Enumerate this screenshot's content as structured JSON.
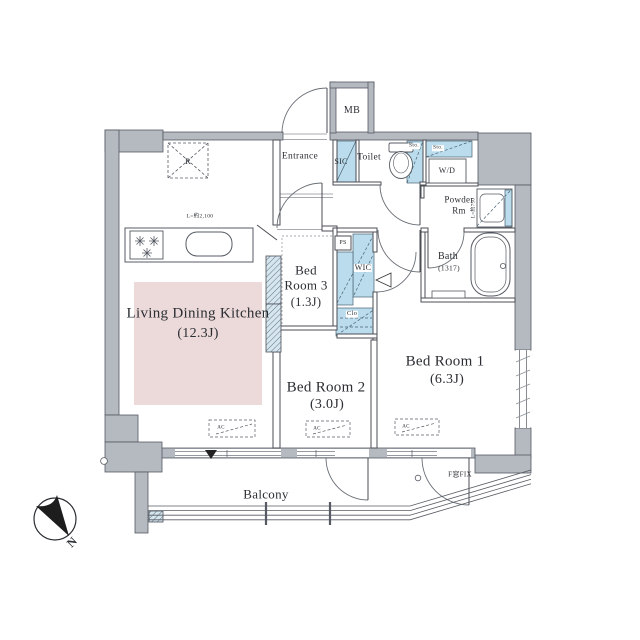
{
  "colors": {
    "wall_fill": "#b5b9c0",
    "wall_stroke": "#565b63",
    "interior_line": "#4a4e55",
    "storage_blue": "#badcec",
    "ldk_pink": "#ecd9d9",
    "text": "#2a2e33"
  },
  "rooms": {
    "ldk": {
      "name": "Living Dining Kitchen",
      "size": "(12.3J)"
    },
    "bedroom1": {
      "name": "Bed Room 1",
      "size": "(6.3J)"
    },
    "bedroom2": {
      "name": "Bed Room 2",
      "size": "(3.0J)"
    },
    "bedroom3": {
      "line1": "Bed",
      "line2": "Room 3",
      "size": "(1.3J)"
    },
    "balcony": {
      "name": "Balcony"
    },
    "entrance": {
      "name": "Entrance"
    },
    "toilet": {
      "name": "Toilet"
    },
    "bath": {
      "name": "Bath",
      "size": "(1317)"
    },
    "powder": {
      "line1": "Powder",
      "line2": "Rm"
    },
    "sic": {
      "name": "SIC"
    },
    "wic": {
      "name": "WIC"
    },
    "closet": {
      "name": "Clo"
    },
    "mb": {
      "name": "MB"
    },
    "wd": {
      "name": "W/D"
    },
    "ps": {
      "name": "PS"
    }
  },
  "annotations": {
    "storage": "Sto.",
    "ac_unit": "AC",
    "refrigerator": "R",
    "kitchen_counter_length": "L=約2,100",
    "vanity_width": "L=約750",
    "fixed_window": "F窓FIX",
    "compass_north": "N"
  }
}
